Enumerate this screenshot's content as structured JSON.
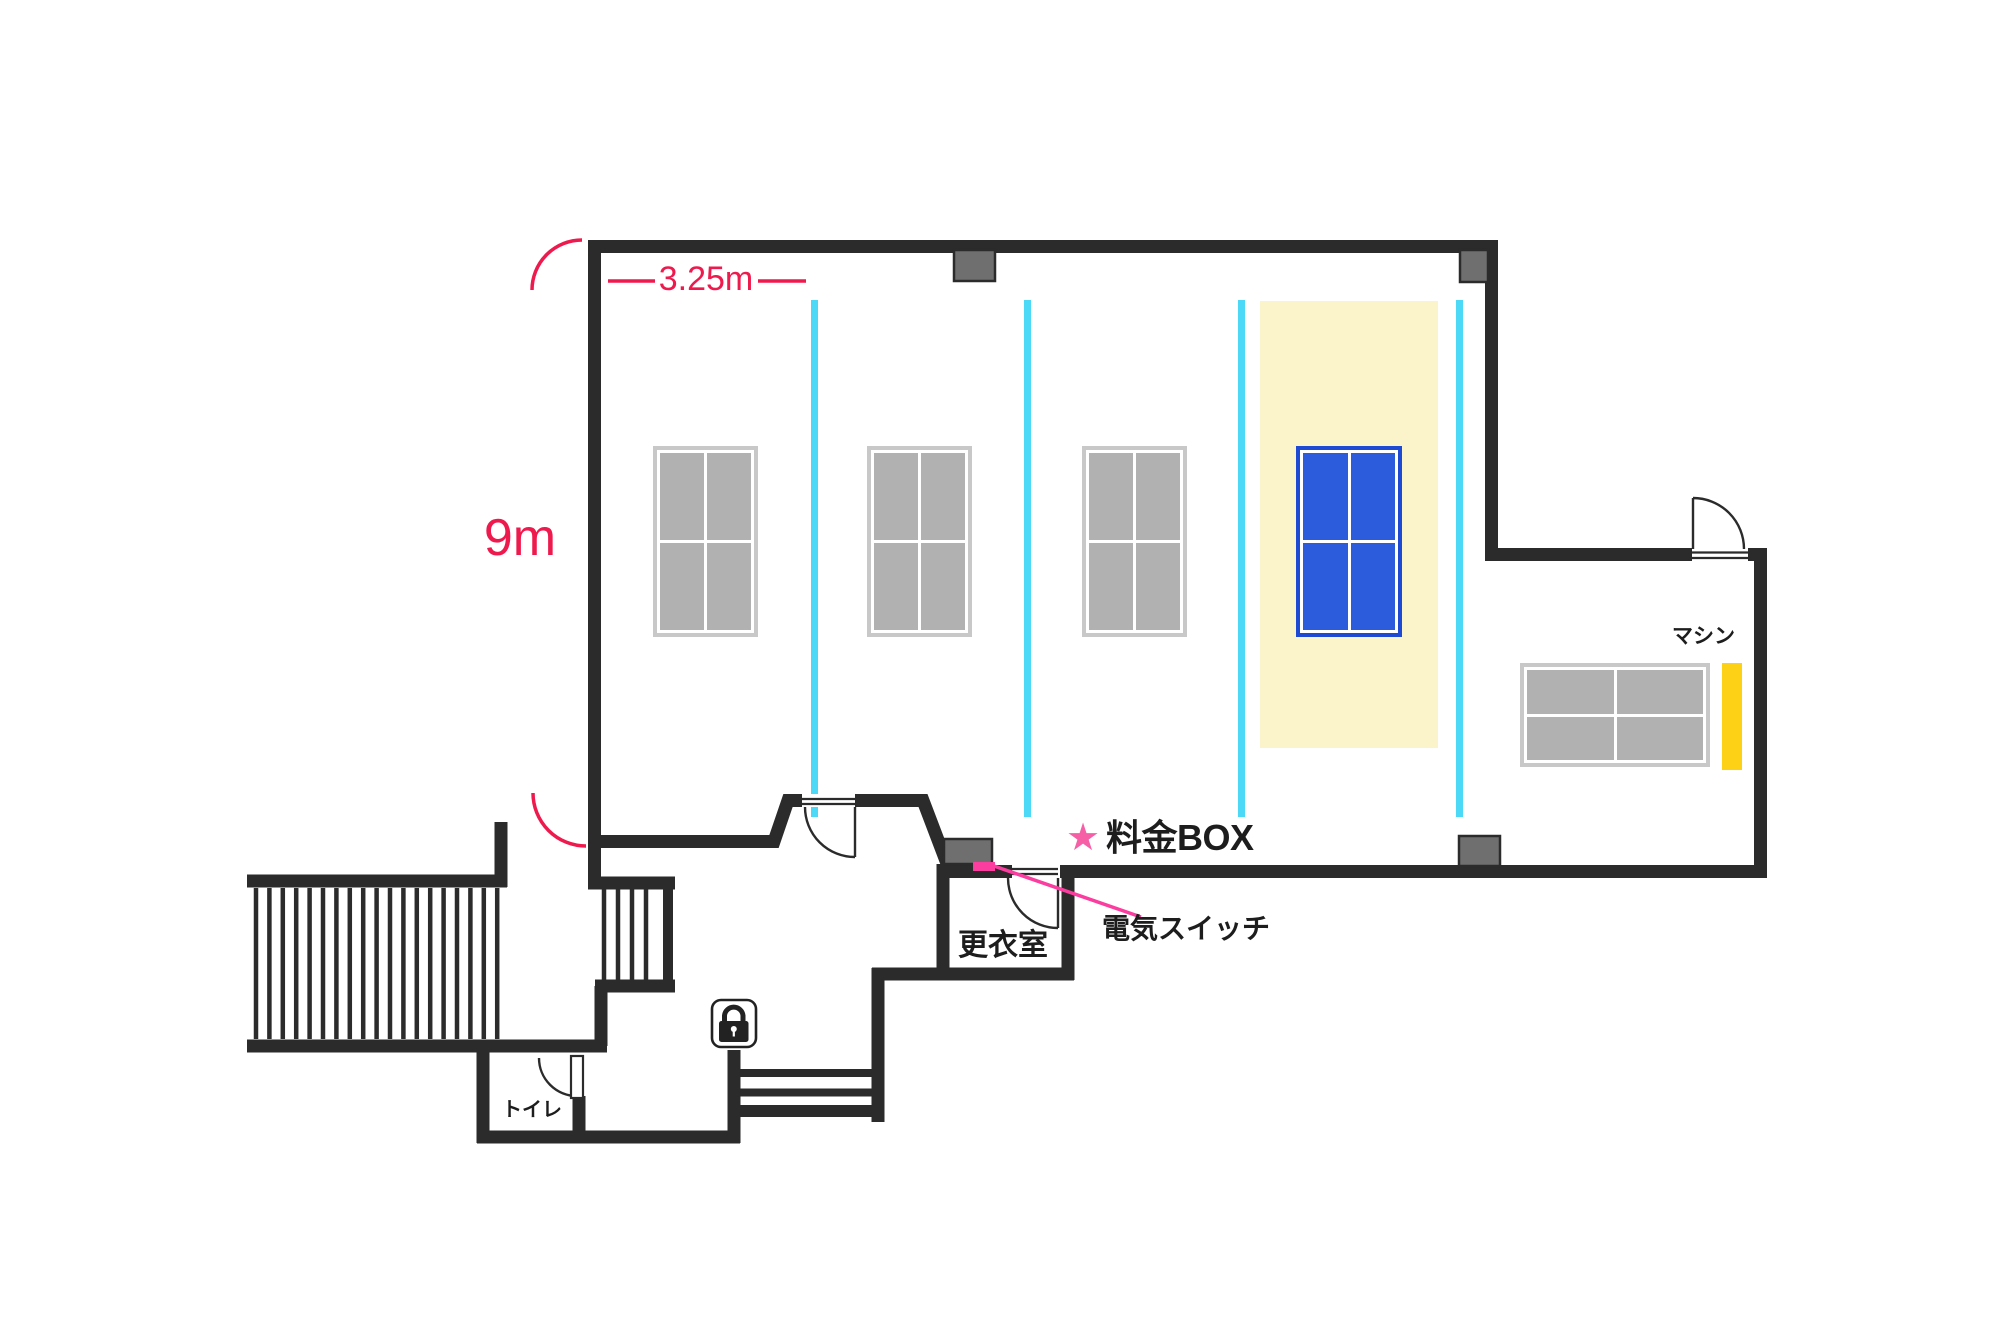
{
  "plan": {
    "title": "table-tennis-floor-plan",
    "dimensions": {
      "width_label": "3.25m",
      "height_label": "9m"
    },
    "annotations": {
      "fee_box_star": "★",
      "fee_box": "料金BOX",
      "light_switch": "電気スイッチ"
    },
    "rooms": {
      "changing_room": "更衣室",
      "toilet": "トイレ"
    },
    "machine_label": "マシン",
    "courts": {
      "lane_count": 4,
      "tables": [
        "gray",
        "gray",
        "gray",
        "blue"
      ],
      "highlighted_lane": 4,
      "annex_table": "gray"
    },
    "colors": {
      "wall": "#2b2b2b",
      "dimension_red": "#ee1a4d",
      "accent_pink_star": "#f65fa6",
      "accent_pink_switch": "#fb3da0",
      "lane_divider_cyan": "#4cd9f8",
      "court_highlight_yellow": "#fbf4ca",
      "table_gray": "#b1b1b1",
      "table_blue": "#2c5bdb",
      "machine_yellow": "#fdd116",
      "pillar_gray": "#6f6f6f"
    }
  }
}
